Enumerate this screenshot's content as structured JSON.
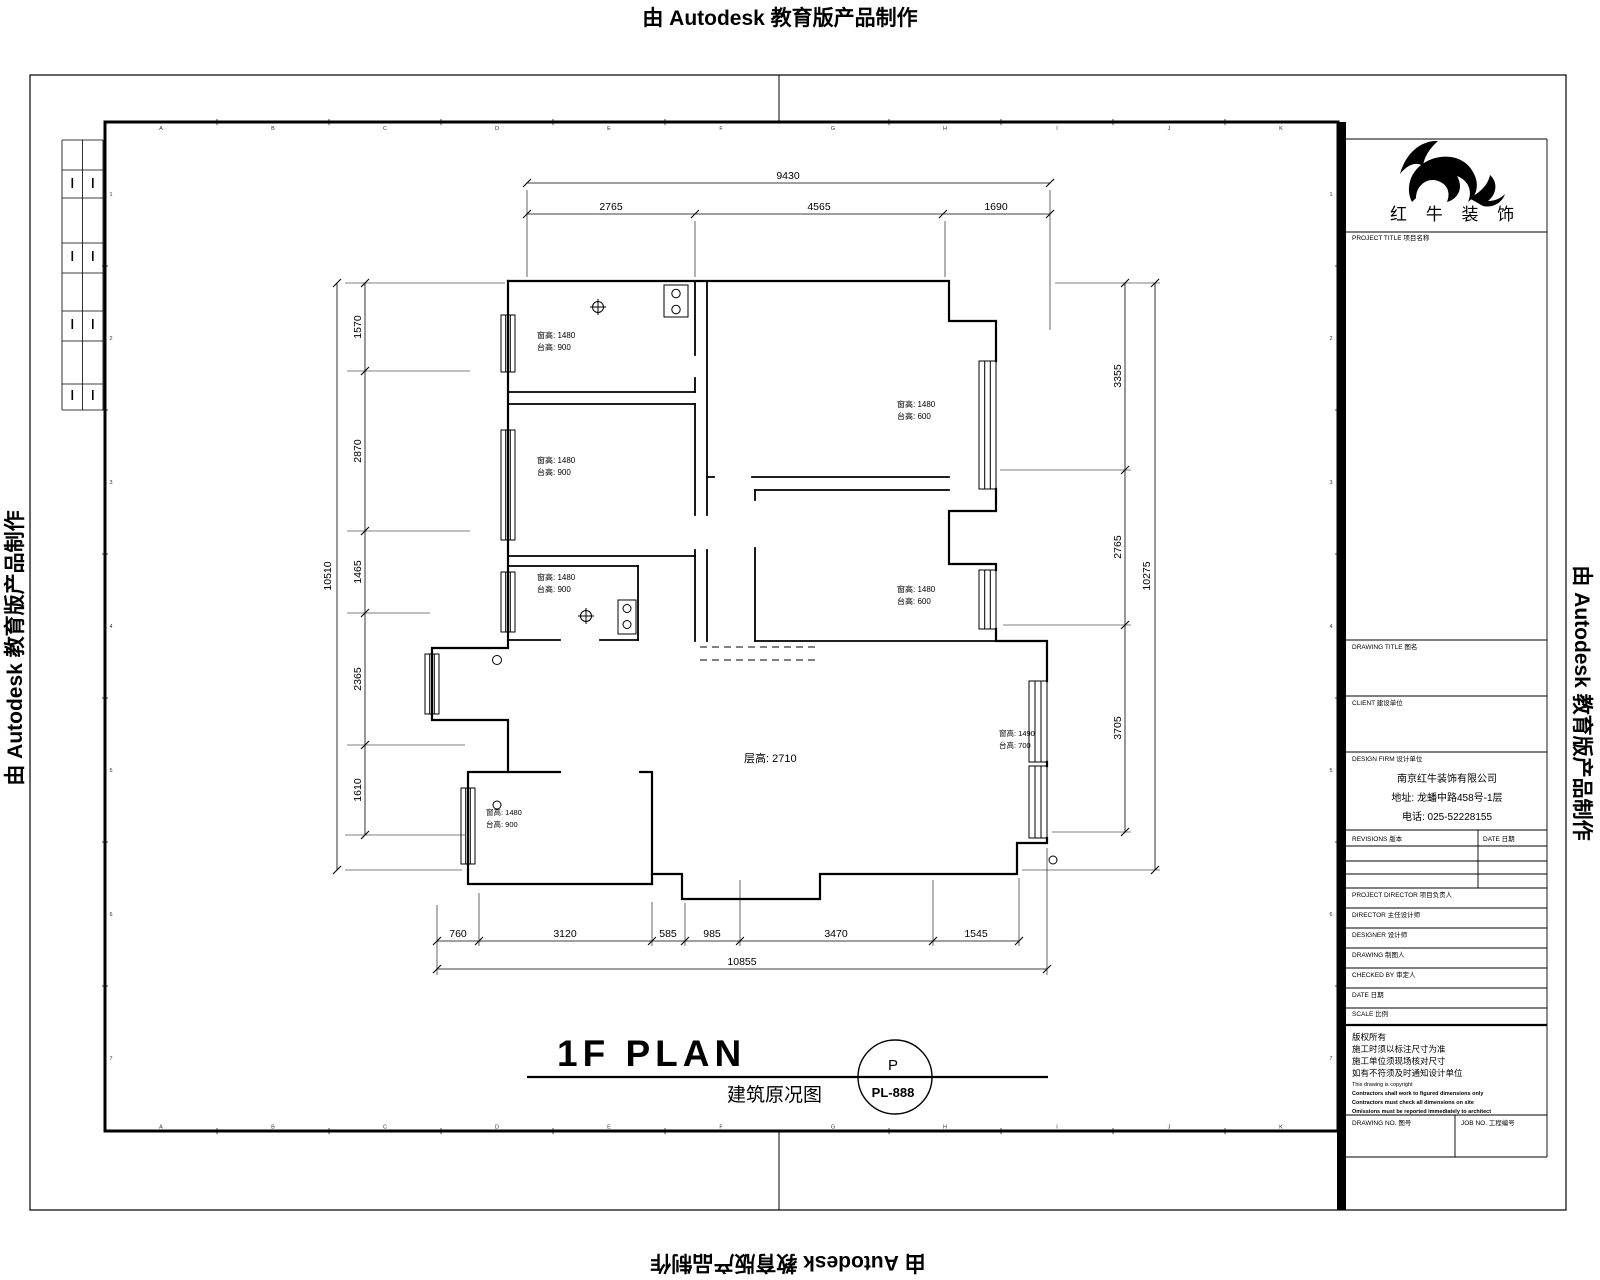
{
  "watermark": {
    "text": "由 Autodesk 教育版产品制作"
  },
  "sheet": {
    "frame_cols": [
      "A",
      "B",
      "C",
      "D",
      "E",
      "F",
      "G",
      "H",
      "I",
      "J",
      "K"
    ],
    "frame_rows": [
      "1",
      "2",
      "3",
      "4",
      "5",
      "6",
      "7"
    ]
  },
  "title_block": {
    "brand_name": "红 牛 装 饰",
    "project_title_label": "PROJECT TITLE 项目名称",
    "drawing_title_label": "DRAWING TITLE 图名",
    "client_label": "CLIENT 建设单位",
    "design_firm_label": "DESIGN FIRM 设计单位",
    "company_name": "南京红牛装饰有限公司",
    "company_address": "地址: 龙蟠中路458号-1层",
    "company_phone": "电话: 025-52228155",
    "revisions_label": "REVISIONS 版本",
    "revision_date_label": "DATE 日期",
    "row_labels": [
      "PROJECT DIRECTOR 项目负责人",
      "DIRECTOR 主任设计师",
      "DESIGNER 设计师",
      "DRAWING 制图人",
      "CHECKED BY 审定人",
      "DATE 日期",
      "SCALE 比例"
    ],
    "notes_cn": [
      "版权所有",
      "施工时须以标注尺寸为准",
      "施工单位须现场核对尺寸",
      "如有不符须及时通知设计单位"
    ],
    "notes_en": [
      "This drawing is copyright",
      "Contractors shall work to figured dimensions only",
      "Contractors must check all dimensions on site",
      "Omissions must be reported immediately to architect"
    ],
    "drawing_no_label": "DRAWING NO. 图号",
    "job_no_label": "JOB NO. 工程编号"
  },
  "plan": {
    "title": "1F PLAN",
    "subtitle": "建筑原况图",
    "ref_letter": "P",
    "ref_number": "PL-888",
    "floor_height_label": "层高: 2710",
    "dims": {
      "top_total": "9430",
      "top": [
        "2765",
        "4565",
        "1690"
      ],
      "left_total": "10510",
      "left": [
        "1570",
        "2870",
        "1465",
        "2365",
        "1610"
      ],
      "right_total": "10275",
      "right": [
        "3355",
        "2765",
        "3705"
      ],
      "bottom_total": "10855",
      "bottom": [
        "760",
        "3120",
        "585",
        "985",
        "3470",
        "1545"
      ]
    },
    "room_notes": [
      {
        "l1": "窗高: 1480",
        "l2": "台高: 900"
      },
      {
        "l1": "窗高: 1480",
        "l2": "台高: 900"
      },
      {
        "l1": "窗高: 1480",
        "l2": "台高: 900"
      },
      {
        "l1": "窗高: 1480",
        "l2": "台高: 600"
      },
      {
        "l1": "窗高: 1480",
        "l2": "台高: 600"
      },
      {
        "l1": "窗高: 1490",
        "l2": "台高: 700"
      },
      {
        "l1": "窗高: 1480",
        "l2": "台高: 900"
      }
    ]
  }
}
